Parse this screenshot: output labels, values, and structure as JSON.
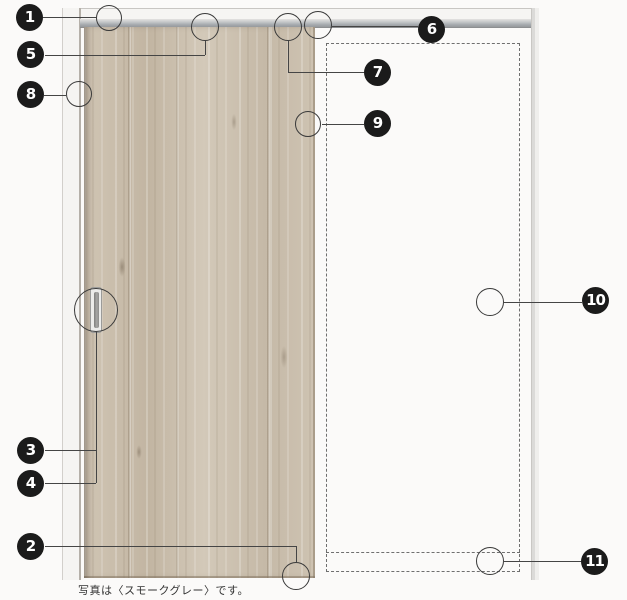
{
  "diagram": {
    "caption": "写真は〈スモークグレー〉です。",
    "callouts": [
      {
        "num": "1"
      },
      {
        "num": "2"
      },
      {
        "num": "3"
      },
      {
        "num": "4"
      },
      {
        "num": "5"
      },
      {
        "num": "6"
      },
      {
        "num": "7"
      },
      {
        "num": "8"
      },
      {
        "num": "9"
      },
      {
        "num": "10"
      },
      {
        "num": "11"
      }
    ],
    "colors": {
      "callout_bg": "#1b1b1b",
      "callout_text": "#ffffff",
      "wood_base": "#cbbfae",
      "rail_gray": "#a6abaf",
      "leader_line": "#454545"
    }
  }
}
